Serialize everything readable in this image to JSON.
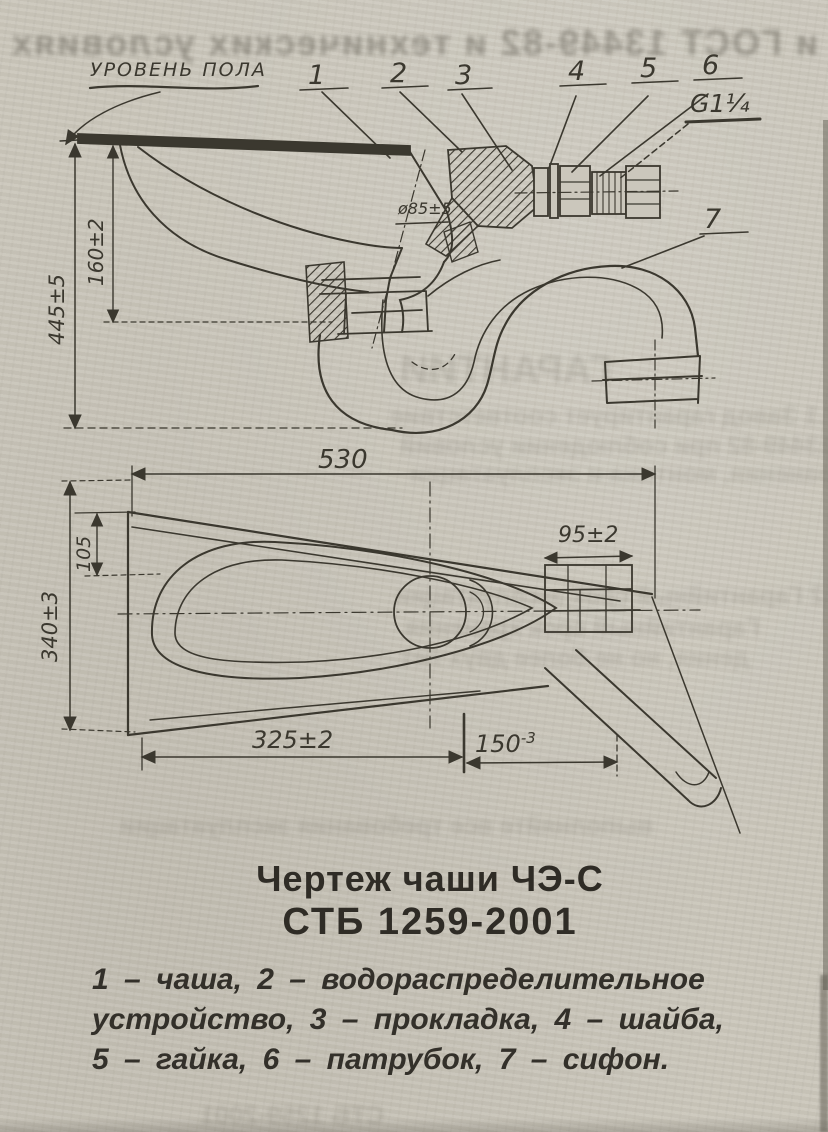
{
  "page": {
    "paper_color": "#cbc7bc",
    "ink_color": "#3b382f"
  },
  "drawing": {
    "floor_label": "УРОВЕНЬ ПОЛА",
    "thread_label": "G1¼",
    "callouts": [
      "1",
      "2",
      "3",
      "4",
      "5",
      "6",
      "7"
    ],
    "dims": {
      "height_total": "445±5",
      "bowl_depth": "160±2",
      "outlet_dia": "ø85±5",
      "length": "530",
      "width": "340±3",
      "rim_offset": "105",
      "spud_length": "95±2",
      "outlet_from_left": "325±2",
      "outlet_150": {
        "value": "150",
        "tol": "-3"
      }
    }
  },
  "caption": {
    "line1": "Чертеж чаши ЧЭ-С",
    "line2": "СТБ 1259-2001"
  },
  "legend": {
    "line1": "1 – чаша, 2 – водораспределительное",
    "line2": "устройство, 3 – прокладка, 4 – шайба,",
    "line3": "5 – гайка, 6 – патрубок, 7 – сифон."
  },
  "ghost_bleedthrough": {
    "top": "и ГОСТ 13449-82 и технических условиях",
    "f1": "ГАРАНТИИ",
    "f2": "7.1 Завод гарантирует соответствие",
    "f3": "ГОСТ 13449-82 при соблюдении условий",
    "f4": "хранения, монтажа и эксплуатации",
    "f5": "7.2 Гарантийный срок эксплуатации",
    "f6": "Гарантийный срок хранения",
    "f7": "дения, но не более двух лет",
    "f8": "выполняйте все требования эксплуатации",
    "f9": "СТБ 1259-2001"
  }
}
